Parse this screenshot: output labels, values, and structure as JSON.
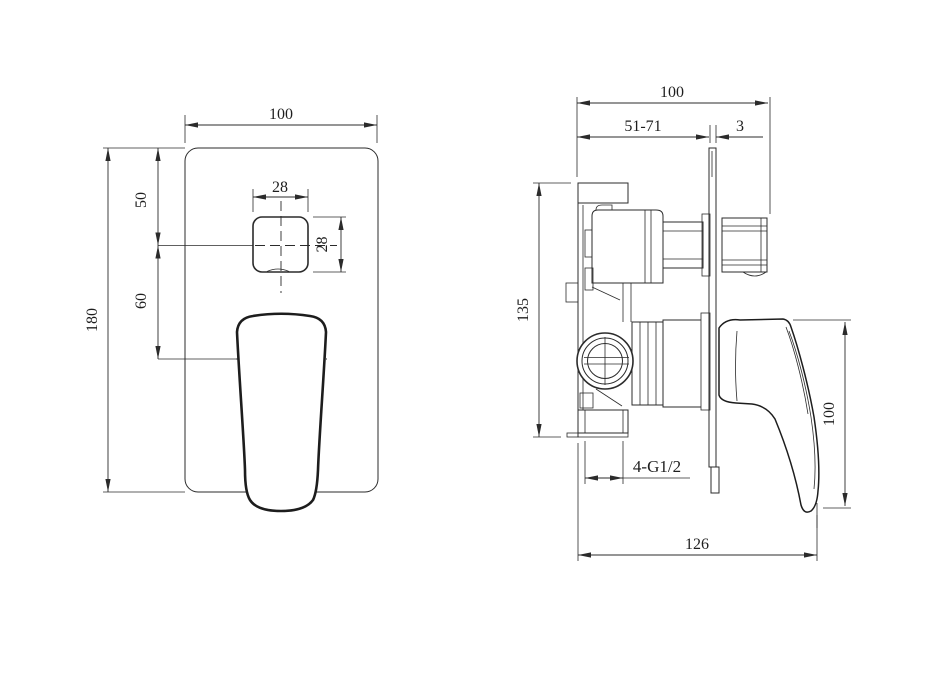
{
  "page": {
    "background": "#ffffff",
    "line_color": "#2b2b2b",
    "text_color": "#1e1e1e",
    "description": "technical drawing of concealed shower mixer valve, front and side views"
  },
  "front_view": {
    "dims": {
      "plate_width": "100",
      "knob_width": "28",
      "knob_height": "28",
      "knob_center_from_top": "50",
      "knob_to_handle": "60",
      "plate_height": "180"
    }
  },
  "side_view": {
    "dims": {
      "overall_depth": "100",
      "rough_in_range": "51-71",
      "plate_thickness": "3",
      "valve_body_height": "135",
      "handle_height": "100",
      "body_length": "126",
      "connection_thread": "4-G1/2"
    }
  }
}
